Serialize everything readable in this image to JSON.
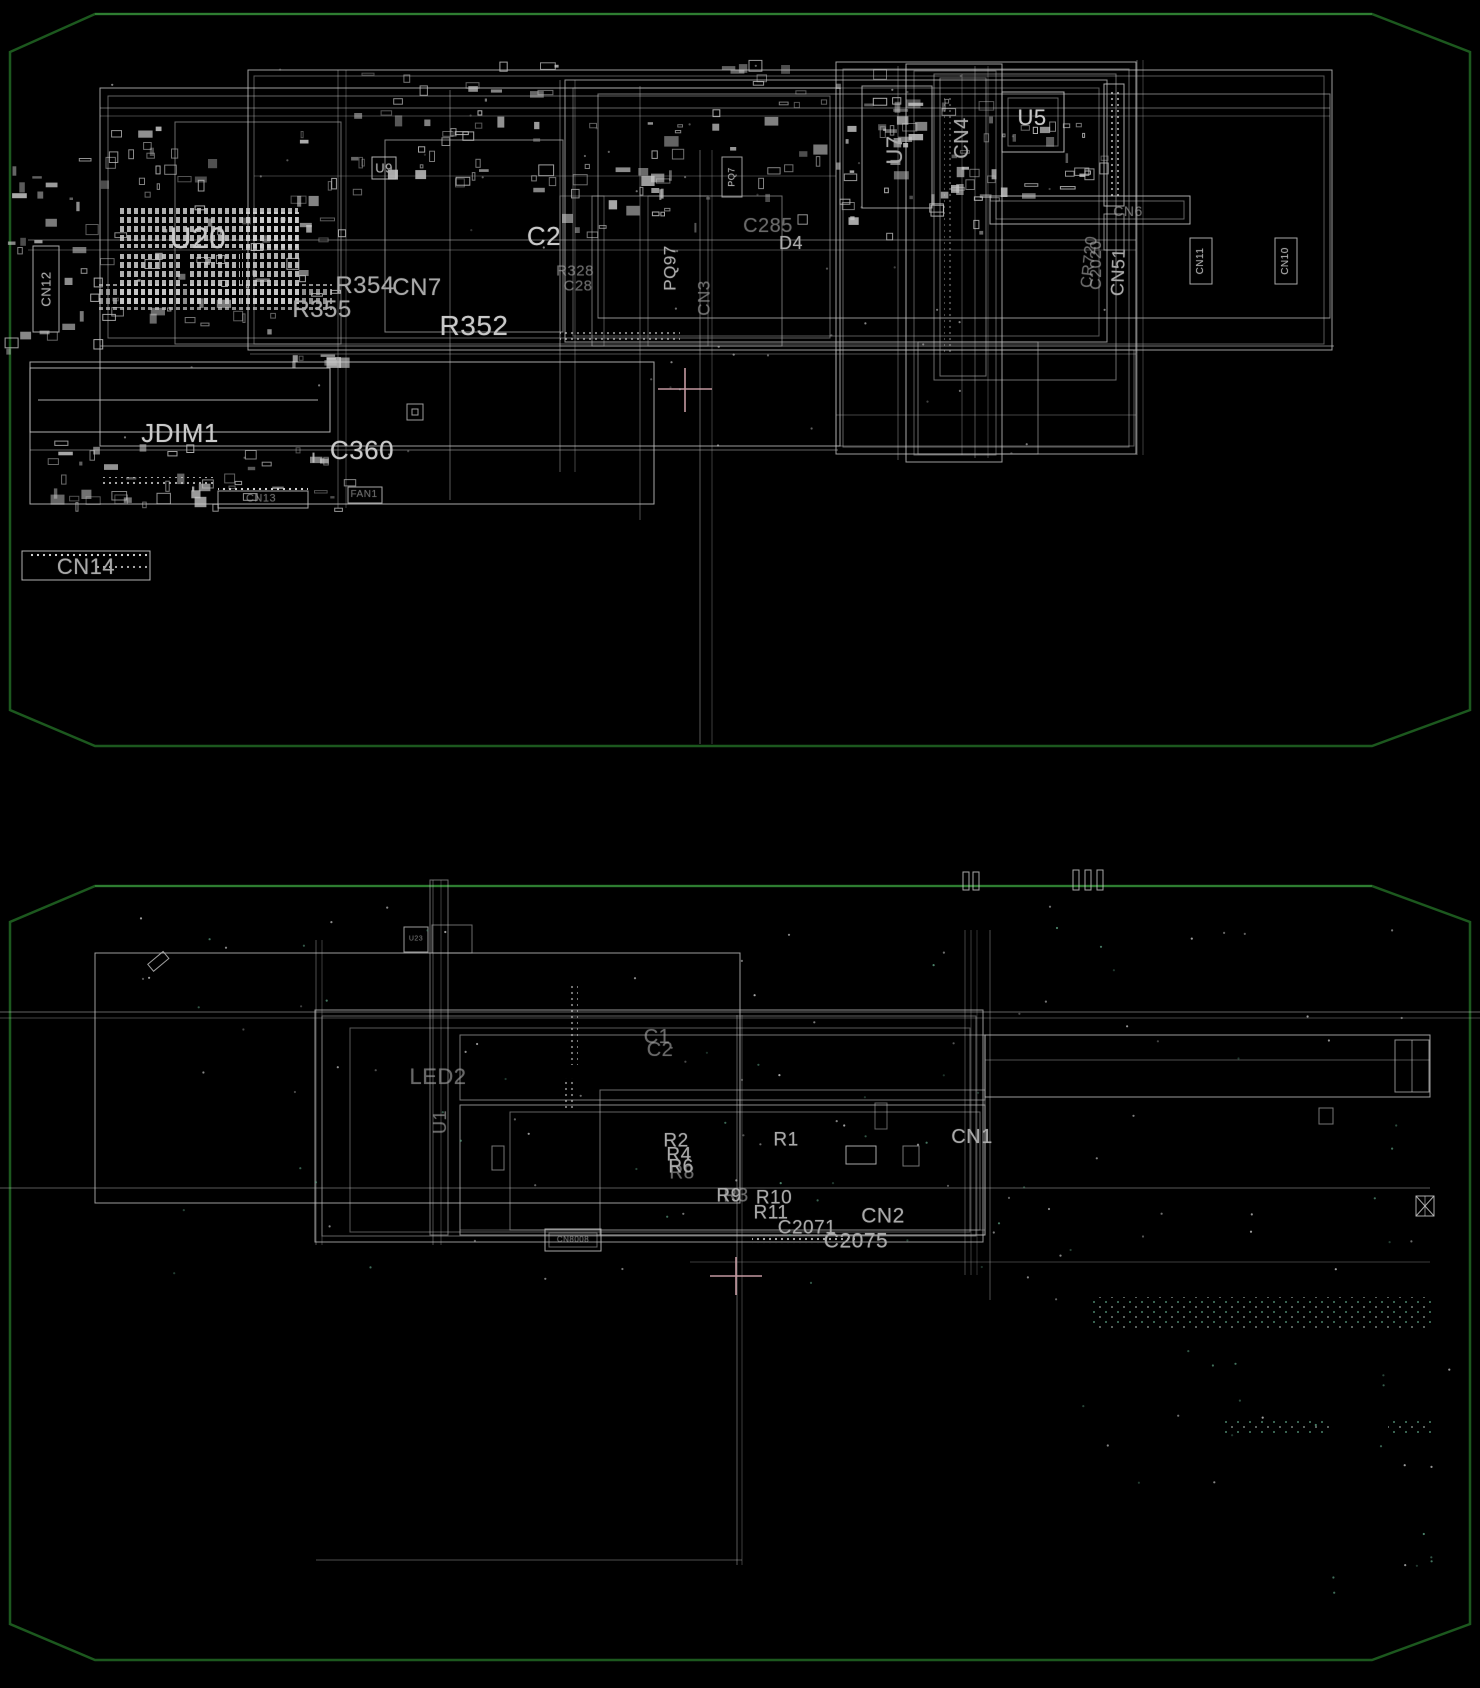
{
  "colors": {
    "background": "#000000",
    "board_outline_green": "#1c581e",
    "silkscreen_gray": "#c4c4c4",
    "label_gray": "#a9a9a9",
    "via_teal": "#5da183",
    "crosshair_pink": "#d9a9b2"
  },
  "top_board": {
    "labels": {
      "u20": "U20",
      "cn12": "CN12",
      "u9": "U9",
      "c2": "C2",
      "cn7": "CN7",
      "r354": "R354",
      "r355": "R355",
      "r352": "R352",
      "r328": "R328",
      "c28": "C28",
      "pq97": "PQ97",
      "cn3": "CN3",
      "pq7": "PQ7",
      "c285": "C285",
      "d4": "D4",
      "u7": "U7",
      "cn4": "CN4",
      "u5": "U5",
      "cn6": "CN6",
      "c2020": "C2020",
      "cr720": "CR720",
      "cn51": "CN51",
      "cn11": "CN11",
      "cn10": "CN10",
      "jdim1": "JDIM1",
      "c360": "C360",
      "cn13": "CN13",
      "fan1": "FAN1",
      "cn14": "CN14"
    }
  },
  "bottom_board": {
    "labels": {
      "c1": "C1",
      "c2": "C2",
      "led2": "LED2",
      "u1": "U1",
      "u23": "U23",
      "r2": "R2",
      "r4": "R4",
      "r6": "R6",
      "r8": "R8",
      "r1": "R1",
      "r9": "R9",
      "r3": "R3",
      "r10": "R10",
      "r11": "R11",
      "c2071": "C2071",
      "cn2": "CN2",
      "c2075": "C2075",
      "cn1": "CN1",
      "cn8008": "CN8008"
    }
  }
}
